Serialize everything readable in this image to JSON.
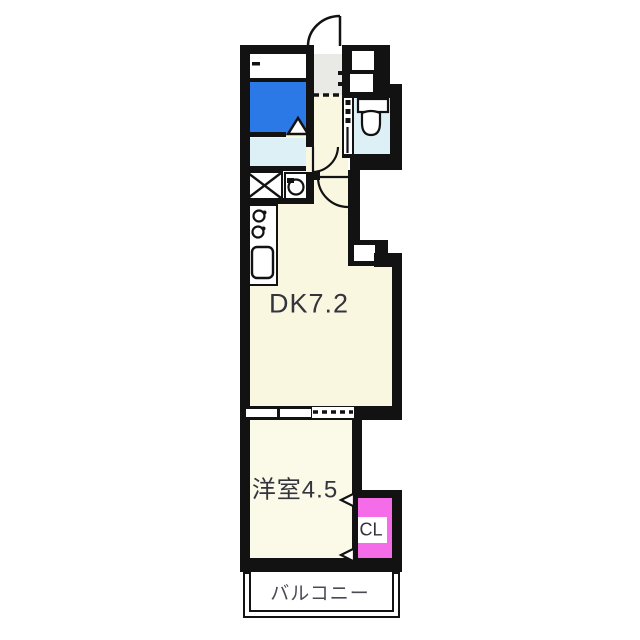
{
  "floorplan": {
    "labels": {
      "dk": "DK7.2",
      "western": "洋室4.5",
      "closet": "CL",
      "balcony": "バルコニー"
    },
    "fixtures": [
      "entrance-door",
      "bathtub",
      "bathroom-folding-door",
      "washbasin",
      "washing-machine-pan",
      "stove-burners",
      "kitchen-sink",
      "toilet",
      "interior-door",
      "closet-folding-door",
      "sliding-window"
    ],
    "colors": {
      "wall": "#121212",
      "room_cream": "#faf7e1",
      "room_cream2": "#fbf9e8",
      "bath_blue": "#2b79e6",
      "water_cyan": "#dcf0f6",
      "entry_gray": "#e9e9e6",
      "closet_magenta": "#f46ce8",
      "label_dark": "#33343c",
      "balcony_label": "#4a4a55"
    }
  }
}
